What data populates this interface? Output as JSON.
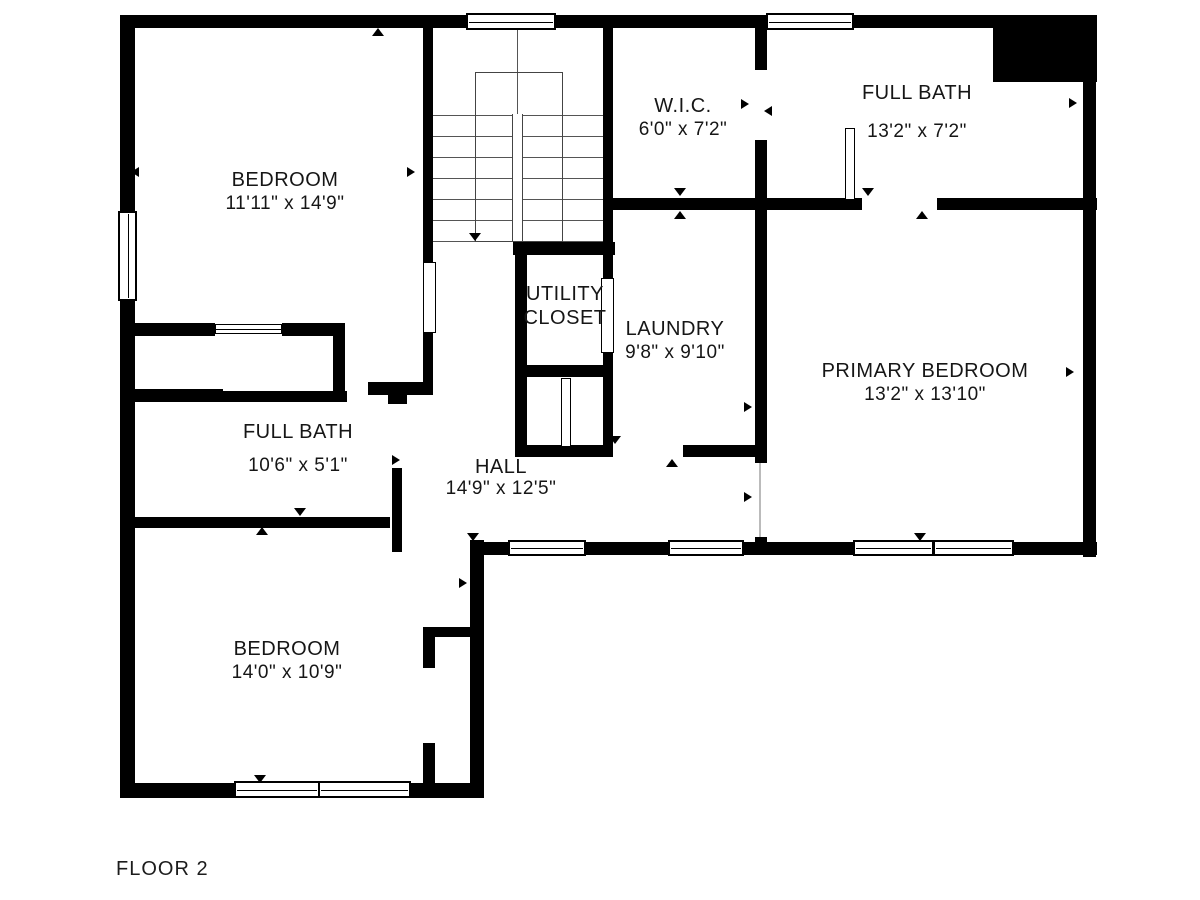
{
  "floor_label": "FLOOR 2",
  "colors": {
    "wall": "#000000",
    "background": "#ffffff",
    "text": "#161616"
  },
  "rooms": {
    "bedroom_nw": {
      "name": "BEDROOM",
      "dims": "11'11\" x 14'9\""
    },
    "wic": {
      "name": "W.I.C.",
      "dims": "6'0\" x 7'2\""
    },
    "full_bath_ne": {
      "name": "FULL BATH",
      "dims": "13'2\" x 7'2\""
    },
    "utility_closet": {
      "line1": "UTILITY",
      "line2": "CLOSET"
    },
    "laundry": {
      "name": "LAUNDRY",
      "dims": "9'8\" x 9'10\""
    },
    "primary_bedroom": {
      "name": "PRIMARY BEDROOM",
      "dims": "13'2\" x 13'10\""
    },
    "full_bath_w": {
      "name": "FULL BATH",
      "dims": "10'6\" x 5'1\""
    },
    "hall": {
      "name": "HALL",
      "dims": "14'9\" x 12'5\""
    },
    "bedroom_sw": {
      "name": "BEDROOM",
      "dims": "14'0\" x 10'9\""
    }
  }
}
